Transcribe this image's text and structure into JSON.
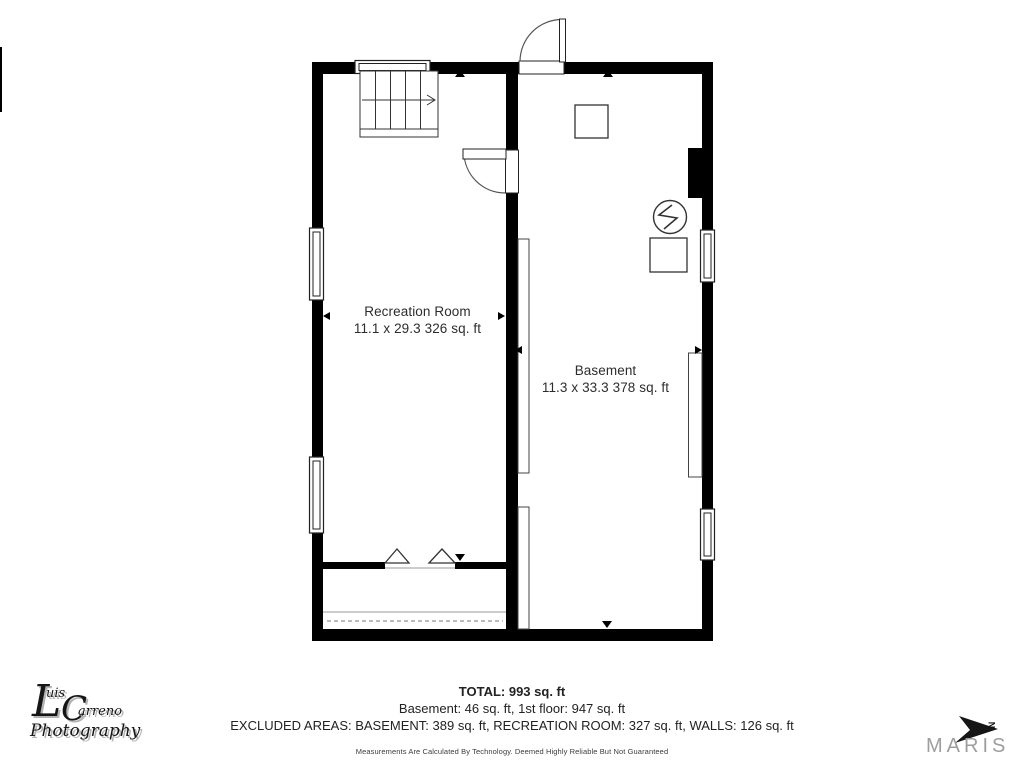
{
  "rooms": [
    {
      "name": "Recreation Room",
      "dims": "11.1 x 29.3 326 sq. ft"
    },
    {
      "name": "Basement",
      "dims": "11.3 x 33.3 378 sq. ft"
    }
  ],
  "summary": {
    "total": "TOTAL: 993 sq. ft",
    "floors": "Basement: 46 sq. ft, 1st floor: 947 sq. ft",
    "excluded": "EXCLUDED AREAS: BASEMENT: 389 sq. ft, RECREATION ROOM: 327 sq. ft, WALLS: 126 sq. ft",
    "disclaimer": "Measurements Are Calculated By Technology. Deemed Highly Reliable But Not Guaranteed"
  },
  "branding": {
    "photographer": {
      "l": "L",
      "uis": "uis",
      "c": "C",
      "arreno": "arreno",
      "photography": "Photography"
    },
    "maris": "MARIS",
    "north": "N"
  },
  "colors": {
    "background": "#ffffff",
    "walls": "#000000",
    "thin_lines": "#333333",
    "label_text": "#2d2d2d",
    "maris_gray": "#9e9e9e"
  }
}
